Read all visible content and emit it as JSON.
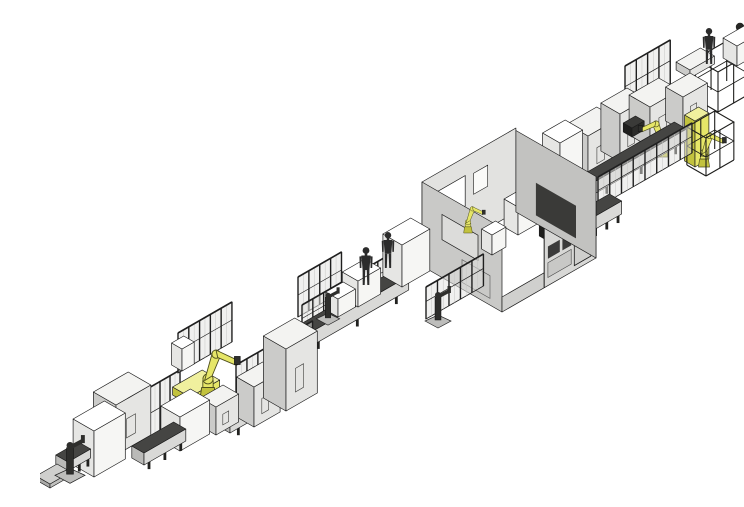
{
  "palette": {
    "background": "#ffffff",
    "outline": "#1b1b1b",
    "robot_yellow": "#e6e668",
    "robot_yellow_dark": "#c2c23e",
    "robot_yellow_light": "#f0f09e",
    "machine_top": "#f3f3f1",
    "machine_front": "#e5e5e3",
    "machine_side": "#cbcbc9",
    "white_top": "#ffffff",
    "white_front": "#f6f6f4",
    "white_side": "#e6e6e4",
    "conv_top": "#454543",
    "conv_front": "#d9d9d7",
    "conv_side": "#babab8",
    "dark_top": "#3a3a38",
    "dark_front": "#2c2c2a",
    "dark_side": "#1f1f1d",
    "plate_top": "#cfcfcd",
    "plate_front": "#c0c0be",
    "plate_side": "#aaaaa8",
    "wall_back": "#e2e2e0",
    "wall_left": "#c9c9c7",
    "wall_front": "#d8d8d6",
    "wall_right": "#c2c2c0",
    "fence_panel": "rgba(226,226,224,0.5)",
    "fence_post": "#1f1f1f",
    "window_dark": "#3a3a3a"
  },
  "scene": {
    "width": 744,
    "height": 475,
    "elements": [
      {
        "t": "rack",
        "n": "material-rack-frame",
        "p": [
          678,
          96
        ],
        "a": 36,
        "b": 26,
        "h": 40
      },
      {
        "t": "colrobot",
        "n": "pedestal-robot-arm",
        "p": [
          731,
          92
        ]
      },
      {
        "t": "box",
        "n": "white-enclosure-box",
        "p": [
          697,
          50
        ],
        "a": 24,
        "b": 16,
        "h": 20,
        "c": "white"
      },
      {
        "t": "box",
        "n": "operator-platform",
        "p": [
          650,
          62
        ],
        "a": 28,
        "b": 16,
        "h": 8,
        "c": "machine"
      },
      {
        "t": "person",
        "n": "operator-figure",
        "p": [
          669,
          48
        ],
        "s": 0.95
      },
      {
        "t": "fence",
        "n": "safety-fence",
        "p": [
          585,
          96
        ],
        "a": 52,
        "h": 46
      },
      {
        "t": "box",
        "n": "machine-cabinet",
        "p": [
          548,
          162
        ],
        "a": 34,
        "b": 24,
        "h": 42,
        "c": "machine"
      },
      {
        "t": "box",
        "n": "machine-cabinet",
        "p": [
          580,
          146
        ],
        "a": 30,
        "b": 22,
        "h": 48,
        "c": "machine"
      },
      {
        "t": "box",
        "n": "machine-cabinet",
        "p": [
          610,
          131
        ],
        "a": 34,
        "b": 24,
        "h": 40,
        "c": "machine"
      },
      {
        "t": "box",
        "n": "machine-cabinet",
        "p": [
          643,
          115
        ],
        "a": 28,
        "b": 20,
        "h": 34,
        "c": "machine"
      },
      {
        "t": "box",
        "n": "control-unit",
        "p": [
          592,
          121
        ],
        "a": 14,
        "b": 10,
        "h": 9,
        "c": "dark"
      },
      {
        "t": "robotY",
        "n": "six-axis-robot",
        "p": [
          622,
          141
        ],
        "s": 0.85,
        "f": 1
      },
      {
        "t": "box",
        "n": "vertical-robot-column",
        "p": [
          655,
          151
        ],
        "a": 16,
        "b": 12,
        "h": 46,
        "c": "yellow"
      },
      {
        "t": "robotY",
        "n": "six-axis-robot",
        "p": [
          664,
          151
        ],
        "s": 0.8
      },
      {
        "t": "rack",
        "n": "material-rack-frame",
        "p": [
          666,
          160
        ],
        "a": 32,
        "b": 22,
        "h": 38
      },
      {
        "t": "conv",
        "n": "conveyor-segment",
        "p": [
          556,
          177
        ],
        "a": 104,
        "h": 12
      },
      {
        "t": "fence",
        "n": "safety-fence",
        "p": [
          558,
          191
        ],
        "a": 108,
        "h": 30
      },
      {
        "t": "box",
        "n": "white-enclosure-box",
        "p": [
          520,
          173
        ],
        "a": 26,
        "b": 20,
        "h": 46,
        "c": "white"
      },
      {
        "t": "box",
        "n": "machine-cabinet",
        "p": [
          497,
          185
        ],
        "a": 20,
        "b": 16,
        "h": 30,
        "c": "machine"
      },
      {
        "t": "conv",
        "n": "conveyor-segment",
        "p": [
          552,
          215
        ],
        "a": 34,
        "h": 13
      },
      {
        "t": "roomback",
        "n": "process-room-walls",
        "F": [
          462,
          296
        ],
        "a": 108,
        "b": 92,
        "h": 84
      },
      {
        "t": "box",
        "n": "white-enclosure-box",
        "p": [
          478,
          219
        ],
        "a": 24,
        "b": 16,
        "h": 28,
        "c": "white"
      },
      {
        "t": "box",
        "n": "white-enclosure-box",
        "p": [
          452,
          239
        ],
        "a": 16,
        "b": 12,
        "h": 20,
        "c": "white"
      },
      {
        "t": "box",
        "n": "equipment-unit",
        "p": [
          508,
          225
        ],
        "a": 20,
        "b": 10,
        "h": 12,
        "c": "dark"
      },
      {
        "t": "robotY",
        "n": "six-axis-robot",
        "p": [
          428,
          217
        ],
        "s": 0.62
      },
      {
        "t": "roomfront",
        "n": "process-room-front",
        "F": [
          462,
          296
        ],
        "a": 108,
        "b": 92,
        "h": 84
      },
      {
        "t": "fence",
        "n": "safety-fence",
        "p": [
          258,
          301
        ],
        "a": 50,
        "h": 40
      },
      {
        "t": "fence",
        "n": "safety-fence",
        "p": [
          262,
          319
        ],
        "a": 112,
        "h": 30
      },
      {
        "t": "conv",
        "n": "conveyor-segment",
        "p": [
          266,
          333
        ],
        "a": 118,
        "h": 14
      },
      {
        "t": "fence",
        "n": "safety-fence",
        "p": [
          386,
          303
        ],
        "a": 66,
        "h": 32
      },
      {
        "t": "box",
        "n": "workstation-table",
        "p": [
          362,
          271
        ],
        "a": 32,
        "b": 22,
        "h": 42,
        "c": "white"
      },
      {
        "t": "box",
        "n": "workstation-table",
        "p": [
          318,
          291
        ],
        "a": 26,
        "b": 18,
        "h": 26,
        "c": "white"
      },
      {
        "t": "box",
        "n": "workstation-table",
        "p": [
          298,
          301
        ],
        "a": 20,
        "b": 14,
        "h": 18,
        "c": "white"
      },
      {
        "t": "robotD",
        "n": "pedestal-robot-small",
        "p": [
          288,
          301
        ],
        "s": 0.9
      },
      {
        "t": "robotD",
        "n": "pedestal-robot-small",
        "p": [
          398,
          303
        ],
        "s": 1
      },
      {
        "t": "person",
        "n": "operator-figure",
        "p": [
          326,
          269
        ],
        "s": 1
      },
      {
        "t": "person",
        "n": "operator-figure",
        "p": [
          348,
          252
        ],
        "s": 0.95
      },
      {
        "t": "fence",
        "n": "safety-fence",
        "p": [
          196,
          403
        ],
        "a": 88,
        "h": 54
      },
      {
        "t": "conv",
        "n": "conveyor-segment",
        "p": [
          190,
          417
        ],
        "a": 80,
        "h": 12
      },
      {
        "t": "box",
        "n": "machine-cabinet",
        "p": [
          214,
          411
        ],
        "a": 30,
        "b": 20,
        "h": 40,
        "c": "machine"
      },
      {
        "t": "box",
        "n": "machine-cabinet",
        "p": [
          246,
          395
        ],
        "a": 36,
        "b": 26,
        "h": 62,
        "c": "machine"
      },
      {
        "t": "fence",
        "n": "safety-fence",
        "p": [
          100,
          435
        ],
        "a": 46,
        "h": 58
      },
      {
        "t": "fence",
        "n": "safety-fence",
        "p": [
          138,
          357
        ],
        "a": 62,
        "h": 40
      },
      {
        "t": "box",
        "n": "white-enclosure-box",
        "p": [
          142,
          355
        ],
        "a": 14,
        "b": 12,
        "h": 22,
        "c": "white"
      },
      {
        "t": "box",
        "n": "robot-base-slab",
        "p": [
          150,
          389
        ],
        "a": 34,
        "b": 20,
        "h": 8,
        "c": "yellow"
      },
      {
        "t": "robotY",
        "n": "six-axis-robot",
        "p": [
          168,
          383
        ],
        "s": 1.15
      },
      {
        "t": "box",
        "n": "machine-cabinet",
        "p": [
          176,
          419
        ],
        "a": 26,
        "b": 18,
        "h": 28,
        "c": "machine"
      },
      {
        "t": "box",
        "n": "white-enclosure-box",
        "p": [
          140,
          435
        ],
        "a": 34,
        "b": 22,
        "h": 34,
        "c": "white"
      },
      {
        "t": "conv",
        "n": "conveyor-segment",
        "p": [
          104,
          449
        ],
        "a": 48,
        "h": 12
      },
      {
        "t": "box",
        "n": "machine-cabinet",
        "p": [
          76,
          439
        ],
        "a": 40,
        "b": 26,
        "h": 50,
        "c": "machine"
      },
      {
        "t": "box",
        "n": "white-enclosure-box",
        "p": [
          54,
          461
        ],
        "a": 36,
        "b": 24,
        "h": 46,
        "c": "white"
      },
      {
        "t": "conv",
        "n": "conveyor-segment",
        "p": [
          28,
          455
        ],
        "a": 26,
        "h": 9
      },
      {
        "t": "box",
        "n": "robot-base-plate",
        "p": [
          10,
          472
        ],
        "a": 24,
        "b": 16,
        "h": 4,
        "c": "plate"
      },
      {
        "t": "robotD",
        "n": "pedestal-robot-small",
        "p": [
          30,
          457
        ],
        "s": 1.15
      }
    ]
  }
}
